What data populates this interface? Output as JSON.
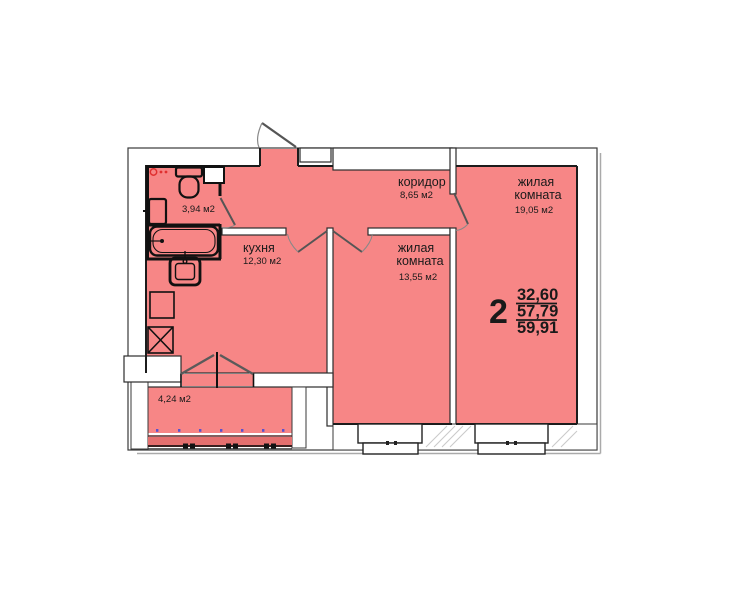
{
  "colors": {
    "room_fill": "#f78686",
    "glazing_band": "#e4706f",
    "wall_dark": "#1c1c1c",
    "wall_double": "#4a4a4a",
    "accent_red": "#e03030",
    "glazing_dot_purple": "#5a52cf"
  },
  "plan": {
    "corridor": {
      "name": "коридор",
      "area": "8,65 м2"
    },
    "living_room_main": {
      "name_line1": "жилая",
      "name_line2": "комната",
      "area": "19,05 м2"
    },
    "living_room_second": {
      "name_line1": "жилая",
      "name_line2": "комната",
      "area": "13,55 м2"
    },
    "kitchen": {
      "name": "кухня",
      "area": "12,30 м2"
    },
    "bathroom": {
      "area": "3,94 м2"
    },
    "balcony": {
      "area": "4,24 м2"
    },
    "apartment_stamp": {
      "rooms_count": "2",
      "living_area": "32,60",
      "floor_area": "57,79",
      "total_area": "59,91"
    }
  }
}
